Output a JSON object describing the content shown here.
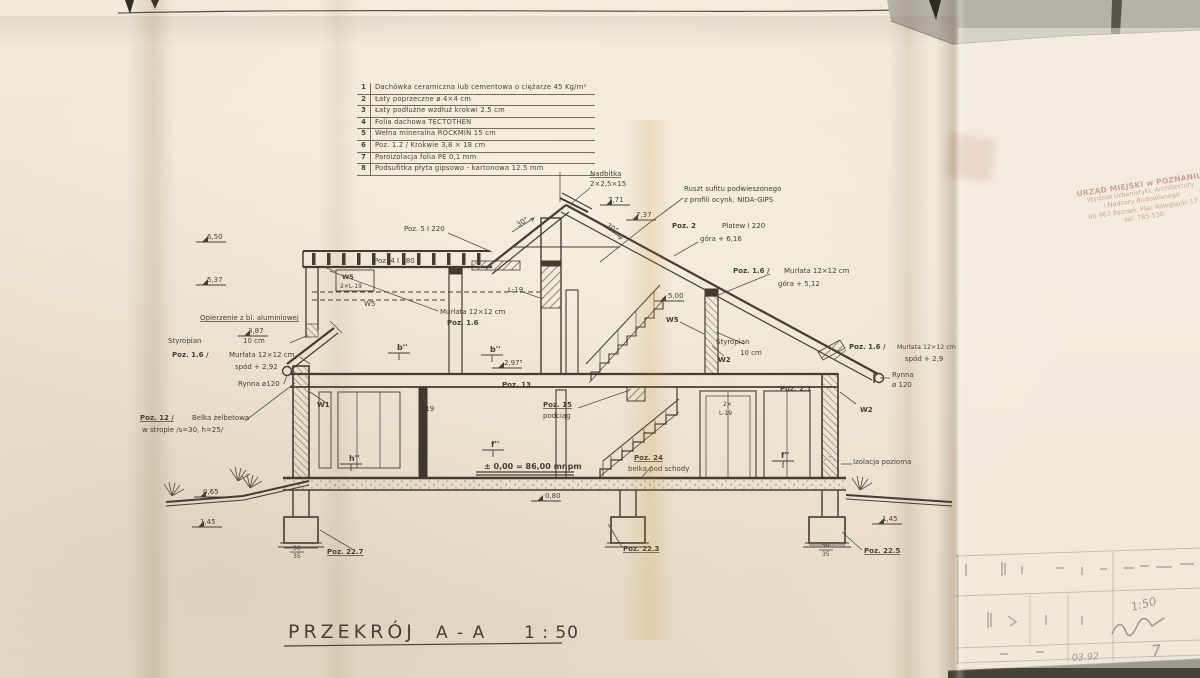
{
  "meta": {
    "drawing_title": "PRZEKRÓJ  A-A  1:50"
  },
  "legend": {
    "rows": [
      {
        "num": "1",
        "text": "Dachówka ceramiczna lub cementowa  o ciężarze 45 Kg/m²"
      },
      {
        "num": "2",
        "text": "Łaty  poprzeczne  ø 4×4 cm"
      },
      {
        "num": "3",
        "text": "Łaty  podłużne  wzdłuż  krokwi  2.5 cm"
      },
      {
        "num": "4",
        "text": "Folia  dachowa  TECTOTHEN"
      },
      {
        "num": "5",
        "text": "Wełna  mineralna  ROCKMIN   15 cm"
      },
      {
        "num": "6",
        "text": "Poz. 1.2 / Krokwie  3,8 × 18 cm"
      },
      {
        "num": "7",
        "text": "Paroizolacja  folia  PE  0,1 mm"
      },
      {
        "num": "8",
        "text": "Podsufitka  płyta  gipsowo - kartonowa  12.5 mm"
      }
    ]
  },
  "stamp": {
    "color": "#a04335",
    "lines": [
      "URZĄD MIEJSKI w POZNANIU",
      "Wydział Urbanistyki, Architektury",
      "i Nadzoru Budowlanego",
      "60-967 Poznań, Plac Kolegiacki 17",
      "tel. 785-530"
    ]
  },
  "title_block": {
    "scale": "1:50",
    "date": "03.92",
    "sheet": "7"
  },
  "drawing": {
    "labels": [
      {
        "t": "6,50",
        "x": 207,
        "y": 239
      },
      {
        "t": "5,37",
        "x": 207,
        "y": 282
      },
      {
        "t": "Opierzenie z bl. aluminiowej",
        "x": 200,
        "y": 320,
        "u": 1
      },
      {
        "t": "3,87",
        "x": 248,
        "y": 333
      },
      {
        "t": "Styropian",
        "x": 168,
        "y": 343
      },
      {
        "t": "10 cm",
        "x": 243,
        "y": 343
      },
      {
        "t": "Poz. 1.6 /",
        "x": 172,
        "y": 357,
        "b": 1
      },
      {
        "t": "Murłata 12×12 cm",
        "x": 229,
        "y": 357
      },
      {
        "t": "spód + 2,92",
        "x": 235,
        "y": 369
      },
      {
        "t": "Rynna ø120",
        "x": 238,
        "y": 386
      },
      {
        "t": "Poz. 12 /",
        "x": 140,
        "y": 420,
        "b": 1,
        "u": 1
      },
      {
        "t": "Belka żelbetowa",
        "x": 192,
        "y": 420
      },
      {
        "t": "w stropie /s=30, h=25/",
        "x": 142,
        "y": 432
      },
      {
        "t": "W1",
        "x": 317,
        "y": 407,
        "b": 1
      },
      {
        "t": "0,65",
        "x": 203,
        "y": 494
      },
      {
        "t": "1,45",
        "x": 200,
        "y": 524
      },
      {
        "t": "30",
        "x": 293,
        "y": 550,
        "fs": 6
      },
      {
        "t": "35",
        "x": 293,
        "y": 558,
        "fs": 6
      },
      {
        "t": "Poz. 22.7",
        "x": 327,
        "y": 554,
        "b": 1,
        "u": 1
      },
      {
        "t": "Poz. 5 I 220",
        "x": 404,
        "y": 231
      },
      {
        "t": "Poz. 4 I 180",
        "x": 374,
        "y": 263
      },
      {
        "t": "W5",
        "x": 342,
        "y": 279,
        "b": 1,
        "fs": 6.5
      },
      {
        "t": "2×L-19",
        "x": 340,
        "y": 288,
        "fs": 6
      },
      {
        "t": "W5",
        "x": 364,
        "y": 306
      },
      {
        "t": "L-19",
        "x": 508,
        "y": 292
      },
      {
        "t": "Murłata 12×12 cm",
        "x": 440,
        "y": 314
      },
      {
        "t": "Poz. 1.6",
        "x": 447,
        "y": 325,
        "b": 1
      },
      {
        "t": "Nadbitka",
        "x": 590,
        "y": 176,
        "u": 1
      },
      {
        "t": "2×2,5×15",
        "x": 590,
        "y": 186
      },
      {
        "t": "7,71",
        "x": 608,
        "y": 202
      },
      {
        "t": "7,37",
        "x": 636,
        "y": 217
      },
      {
        "t": "30°",
        "x": 518,
        "y": 227,
        "r": -30
      },
      {
        "t": "30°",
        "x": 606,
        "y": 227,
        "r": 30
      },
      {
        "t": "Ruszt sufitu podwieszonego",
        "x": 684,
        "y": 191
      },
      {
        "t": "z profili ocynk. NIDA-GIPS",
        "x": 684,
        "y": 202
      },
      {
        "t": "Poz. 2",
        "x": 672,
        "y": 228,
        "b": 1
      },
      {
        "t": "Płatew I 220",
        "x": 722,
        "y": 228
      },
      {
        "t": "góra + 6,16",
        "x": 700,
        "y": 241
      },
      {
        "t": "Poz. 1.6 /",
        "x": 733,
        "y": 273,
        "b": 1
      },
      {
        "t": "Murłata 12×12 cm",
        "x": 784,
        "y": 273
      },
      {
        "t": "góra + 5,12",
        "x": 778,
        "y": 286
      },
      {
        "t": "5,00",
        "x": 668,
        "y": 298
      },
      {
        "t": "W5",
        "x": 666,
        "y": 322,
        "b": 1
      },
      {
        "t": "Styropian",
        "x": 716,
        "y": 344
      },
      {
        "t": "10 cm",
        "x": 740,
        "y": 355
      },
      {
        "t": "W2",
        "x": 718,
        "y": 362,
        "b": 1
      },
      {
        "t": "Poz. 2.1",
        "x": 780,
        "y": 391,
        "b": 1
      },
      {
        "t": "2×",
        "x": 723,
        "y": 406,
        "fs": 6
      },
      {
        "t": "L-19",
        "x": 719,
        "y": 415,
        "fs": 6
      },
      {
        "t": "b''",
        "x": 397,
        "y": 350,
        "b": 1,
        "fs": 8
      },
      {
        "t": "b''",
        "x": 490,
        "y": 352,
        "b": 1,
        "fs": 8
      },
      {
        "t": "2,97⁵",
        "x": 504,
        "y": 365
      },
      {
        "t": "Poz. 13",
        "x": 502,
        "y": 387,
        "b": 1
      },
      {
        "t": "L-19",
        "x": 419,
        "y": 411
      },
      {
        "t": "Poz. 15",
        "x": 543,
        "y": 407,
        "b": 1,
        "u": 1
      },
      {
        "t": "podciąg",
        "x": 543,
        "y": 418
      },
      {
        "t": "f''",
        "x": 491,
        "y": 447,
        "b": 1,
        "fs": 8
      },
      {
        "t": "h''",
        "x": 349,
        "y": 461,
        "b": 1,
        "fs": 8
      },
      {
        "t": "f''",
        "x": 781,
        "y": 458,
        "b": 1,
        "fs": 8
      },
      {
        "t": "± 0,00 = 86,00 mnpm",
        "x": 484,
        "y": 469,
        "b": 1,
        "fs": 8
      },
      {
        "t": "Poz. 24",
        "x": 634,
        "y": 460,
        "b": 1,
        "u": 1
      },
      {
        "t": "belka pod schody",
        "x": 628,
        "y": 471
      },
      {
        "t": "0,80",
        "x": 545,
        "y": 498
      },
      {
        "t": "Poz. 22.3",
        "x": 623,
        "y": 551,
        "b": 1,
        "u": 1
      },
      {
        "t": "Poz. 1.6 /",
        "x": 849,
        "y": 349,
        "b": 1
      },
      {
        "t": "Murłata 12×12 cm",
        "x": 897,
        "y": 349,
        "fs": 6.3
      },
      {
        "t": "spód + 2,9",
        "x": 905,
        "y": 361
      },
      {
        "t": "Rynna",
        "x": 892,
        "y": 377
      },
      {
        "t": "ø 120",
        "x": 892,
        "y": 387
      },
      {
        "t": "W2",
        "x": 860,
        "y": 412,
        "b": 1
      },
      {
        "t": "Izolacja pozioma",
        "x": 853,
        "y": 464
      },
      {
        "t": "1,45",
        "x": 882,
        "y": 521
      },
      {
        "t": "50",
        "x": 822,
        "y": 547,
        "fs": 6
      },
      {
        "t": "35",
        "x": 822,
        "y": 556,
        "fs": 6
      },
      {
        "t": "Poz. 22.5",
        "x": 864,
        "y": 553,
        "b": 1,
        "u": 1
      },
      {
        "t": "PRZEKRÓJ",
        "x": 288,
        "y": 638,
        "fs": 19,
        "ls": 4
      },
      {
        "t": "A - A",
        "x": 436,
        "y": 638,
        "fs": 17,
        "ls": 2
      },
      {
        "t": "1 : 50",
        "x": 524,
        "y": 638,
        "fs": 17,
        "ls": 1
      }
    ],
    "handwriting": [
      {
        "t": "1:50",
        "x": 1132,
        "y": 611,
        "fs": 11.5,
        "r": -14
      },
      {
        "t": "03.92",
        "x": 1072,
        "y": 661,
        "fs": 9.5,
        "r": -4
      },
      {
        "t": "7",
        "x": 1152,
        "y": 657,
        "fs": 16,
        "r": -8
      }
    ]
  }
}
